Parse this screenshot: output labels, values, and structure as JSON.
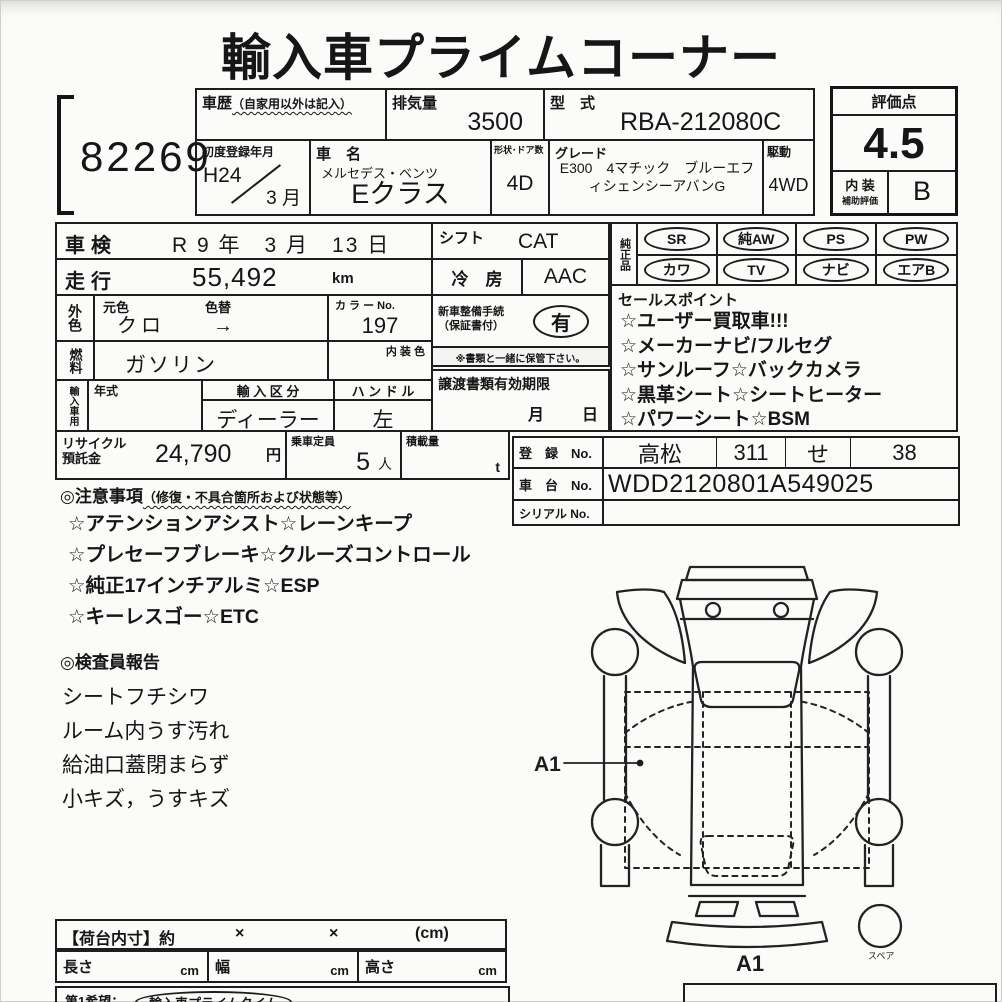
{
  "page": {
    "title": "輸入車プライムコーナー",
    "lot_number": "82269"
  },
  "colors": {
    "ink": "#1d1d1d",
    "paper": "#fbfbf9"
  },
  "top": {
    "history_label": "車歴",
    "history_note": "（自家用以外は記入）",
    "displacement_label": "排気量",
    "displacement_value": "3500",
    "model_code_label": "型　式",
    "model_code_value": "RBA-212080C",
    "first_reg_label": "初度登録年月",
    "first_reg_year": "H24",
    "first_reg_month": "3 月",
    "car_name_label": "車　名",
    "car_maker": "メルセデス・ベンツ",
    "car_model": "Eクラス",
    "shape_label": "形状･ドア数",
    "shape_value": "4D",
    "grade_label": "グレード",
    "grade_value": "E300　4マチック　ブルーエフィシェンシーアバンG",
    "drive_label": "駆動",
    "drive_value": "4WD"
  },
  "score": {
    "label": "評価点",
    "value": "4.5",
    "interior_label_1": "内 装",
    "interior_label_2": "補助評価",
    "interior_grade": "B"
  },
  "left_table": {
    "shaken_label": "車検",
    "shaken_value": "R 9 年　3 月　13 日",
    "mileage_label": "走行",
    "mileage_value": "55,492",
    "mileage_unit": "km",
    "ext_color_label": "外色",
    "orig_color_label": "元色",
    "color_change_label": "色替",
    "orig_color_value": "クロ",
    "color_arrow": "→",
    "color_no_label": "カ ラ ー No.",
    "color_no_value": "197",
    "fuel_label": "燃料",
    "fuel_value": "ガソリン",
    "interior_color_label": "内 装 色",
    "import_label": "輸入車用",
    "year_label": "年式",
    "import_class_label": "輸 入 区 分",
    "import_class_value": "ディーラー",
    "handle_label": "ハ ン ド ル",
    "handle_value": "左",
    "recycle_label_1": "リサイクル",
    "recycle_label_2": "預託金",
    "recycle_value": "24,790",
    "recycle_unit": "円",
    "capacity_label": "乗車定員",
    "capacity_value": "5",
    "capacity_unit": "人",
    "load_label": "積載量",
    "load_unit": "t"
  },
  "mid_table": {
    "shift_label": "シフト",
    "shift_value": "CAT",
    "ac_label": "冷　房",
    "ac_value": "AAC",
    "new_car_label_1": "新車整備手続",
    "new_car_label_2": "（保証書付）",
    "new_car_value": "有",
    "keep_note": "※書類と一緒に保管下さい。",
    "transfer_label": "譲渡書類有効期限",
    "transfer_month": "月",
    "transfer_day": "日"
  },
  "equipment": {
    "label": "純正品",
    "badges": [
      "SR",
      "純AW",
      "PS",
      "PW",
      "カワ",
      "TV",
      "ナビ",
      "エアB"
    ]
  },
  "sales_points": {
    "label": "セールスポイント",
    "items": [
      "☆ユーザー買取車!!!",
      "☆メーカーナビ/フルセグ",
      "☆サンルーフ☆バックカメラ",
      "☆黒革シート☆シートヒーター",
      "☆パワーシート☆BSM"
    ]
  },
  "registration": {
    "reg_label": "登　録　No.",
    "reg_area": "高松",
    "reg_class": "311",
    "reg_kana": "せ",
    "reg_number": "38",
    "chassis_label": "車　台　No.",
    "chassis_value": "WDD2120801A549025",
    "serial_label": "シリアル No."
  },
  "notes": {
    "header": "◎注意事項",
    "header_note": "（修復・不具合箇所および状態等）",
    "items": [
      "☆アテンションアシスト☆レーンキープ",
      "☆プレセーフブレーキ☆クルーズコントロール",
      "☆純正17インチアルミ☆ESP",
      "☆キーレスゴー☆ETC"
    ]
  },
  "inspector": {
    "header": "◎検査員報告",
    "items": [
      "シートフチシワ",
      "ルーム内うす汚れ",
      "給油口蓋閉まらず",
      "小キズ，うすキズ"
    ]
  },
  "diagram": {
    "mark_a1": "A1",
    "bottom_mark": "A1",
    "spare_label": "スペア"
  },
  "bottom": {
    "bed_label": "【荷台内寸】約",
    "x1": "×",
    "x2": "×",
    "unit": "(cm)",
    "length_label": "長さ",
    "length_unit": "cm",
    "width_label": "幅",
    "width_unit": "cm",
    "height_label": "高さ",
    "height_unit": "cm",
    "wish_label": "第1希望：",
    "wish_value": "輸入車プライムタイム"
  }
}
